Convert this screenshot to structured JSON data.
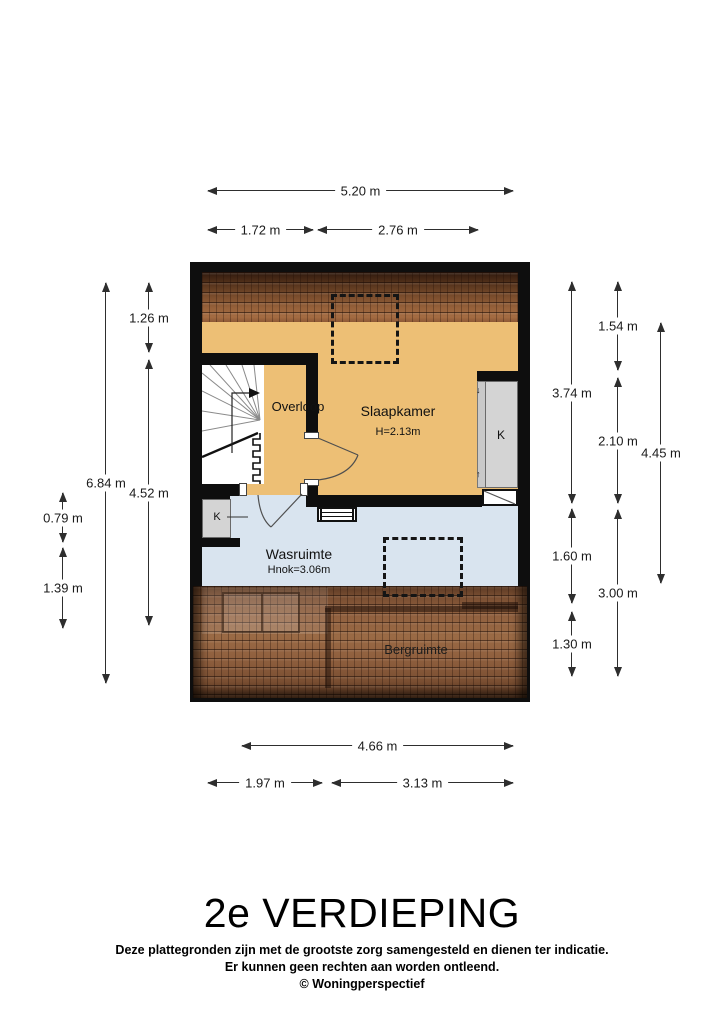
{
  "title": "2e VERDIEPING",
  "footer": {
    "line1": "Deze plattegronden zijn met de grootste zorg samengesteld en dienen ter indicatie.",
    "line2": "Er kunnen geen rechten aan worden ontleend.",
    "line3": "© Woningperspectief"
  },
  "rooms": {
    "overloop": {
      "label": "Overloop"
    },
    "slaapkamer": {
      "label": "Slaapkamer",
      "height": "H=2.13m"
    },
    "wasruimte": {
      "label": "Wasruimte",
      "height": "Hnok=3.06m"
    },
    "bergruimte": {
      "label": "Bergruimte"
    },
    "closet_left": {
      "label": "K"
    },
    "closet_right": {
      "label": "K",
      "slide_marks": [
        "↓",
        "↑"
      ]
    }
  },
  "dimensions": {
    "top_total": "5.20 m",
    "top_left": "1.72 m",
    "top_right": "2.76 m",
    "left_roof": "1.26 m",
    "left_inner": "4.52 m",
    "left_total": "6.84 m",
    "left_closet": "0.79 m",
    "left_lower": "1.39 m",
    "right_slaapkamer": "3.74 m",
    "right_wasruimte": "1.60 m",
    "right_bergruimte": "1.30 m",
    "right_roof": "1.54 m",
    "right_closet": "2.10 m",
    "right_lower": "3.00 m",
    "right_total": "4.45 m",
    "bottom_total": "4.66 m",
    "bottom_left": "1.97 m",
    "bottom_right": "3.13 m"
  },
  "colors": {
    "floor_wood": "#edbf75",
    "floor_laundry": "#d9e4ef",
    "closet_gray": "#d4d4d4",
    "wall": "#0e0e0e",
    "roof_dark": "#462815",
    "roof_light": "#a46c42"
  }
}
